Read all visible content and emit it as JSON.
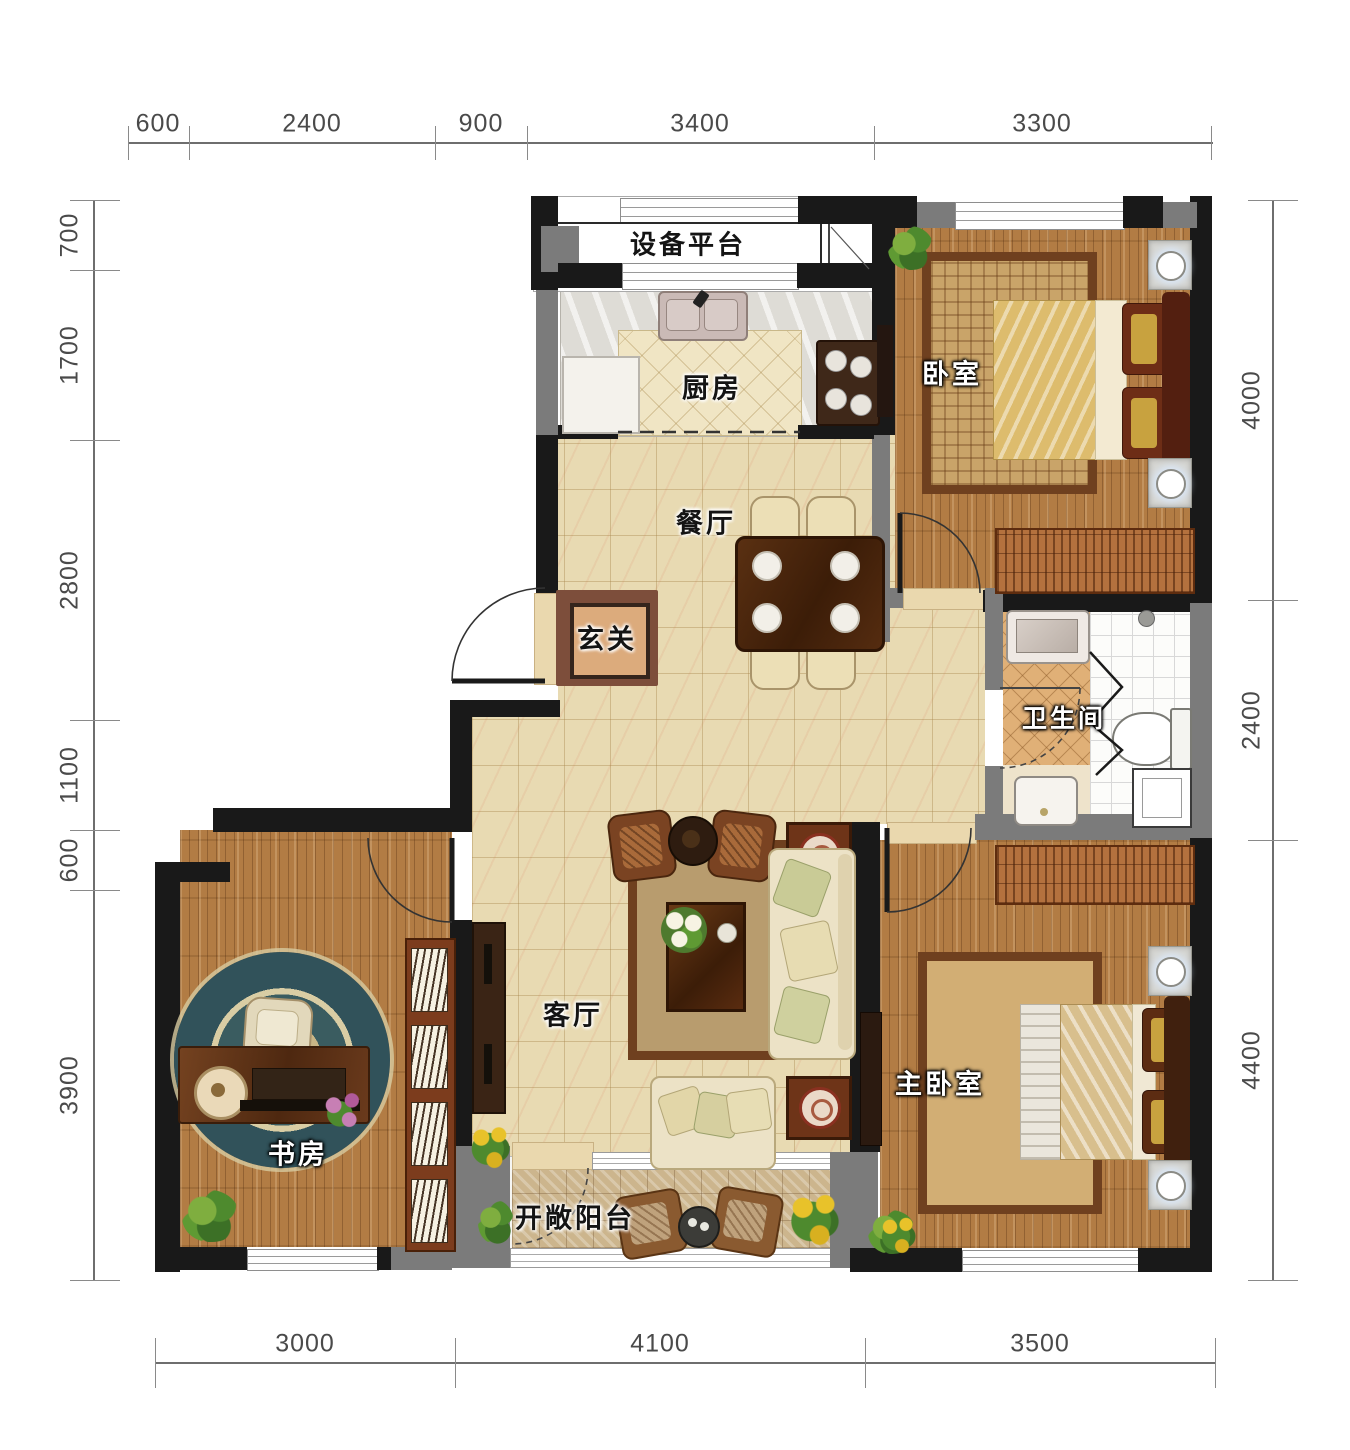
{
  "drawing": {
    "type": "residential floor plan",
    "units": "mm"
  },
  "dimensions": {
    "top": [
      "600",
      "2400",
      "900",
      "3400",
      "3300"
    ],
    "left": [
      "700",
      "1700",
      "2800",
      "1100",
      "600",
      "3900"
    ],
    "right": [
      "4000",
      "2400",
      "4400"
    ],
    "bottom": [
      "3000",
      "4100",
      "3500"
    ]
  },
  "rooms": {
    "equipment_platform": {
      "label": "设备平台",
      "furniture": [
        "window",
        "ac-unit"
      ]
    },
    "kitchen": {
      "label": "厨房",
      "furniture": [
        "sink",
        "stove",
        "fridge",
        "counter"
      ]
    },
    "bedroom": {
      "label": "卧室",
      "furniture": [
        "double-bed",
        "rug",
        "nightstand",
        "nightstand",
        "wardrobe",
        "tv",
        "plant"
      ]
    },
    "dining": {
      "label": "餐厅",
      "furniture": [
        "dining-table",
        "chair",
        "chair",
        "chair",
        "chair"
      ]
    },
    "foyer": {
      "label": "玄关",
      "furniture": [
        "floor-mat"
      ]
    },
    "bathroom": {
      "label": "卫生间",
      "furniture": [
        "washing-machine",
        "sink",
        "toilet",
        "shower",
        "folding-door"
      ]
    },
    "living": {
      "label": "客厅",
      "furniture": [
        "sofa",
        "loveseat",
        "armchair",
        "armchair",
        "coffee-table",
        "side-table",
        "side-table",
        "tv-cabinet",
        "rug",
        "flowers"
      ]
    },
    "study": {
      "label": "书房",
      "furniture": [
        "desk",
        "chair",
        "round-rug",
        "bookshelf",
        "plant"
      ]
    },
    "master_bedroom": {
      "label": "主卧室",
      "furniture": [
        "double-bed",
        "bench",
        "rug",
        "nightstand",
        "nightstand",
        "wardrobe",
        "tv",
        "plant"
      ]
    },
    "balcony": {
      "label": "开敞阳台",
      "furniture": [
        "wicker-chair",
        "wicker-chair",
        "round-table",
        "plant",
        "sunflowers"
      ]
    }
  },
  "colors": {
    "wall": "#191919",
    "wall_secondary": "#7b7b7b",
    "floor_tile": "#e8dab2",
    "floor_wood": "#b27c44",
    "bathroom_tile": "#e0b077",
    "balcony_tile": "#ccb58d",
    "rug_border": "#6f401f",
    "dimension_text": "#4a4a4a"
  }
}
